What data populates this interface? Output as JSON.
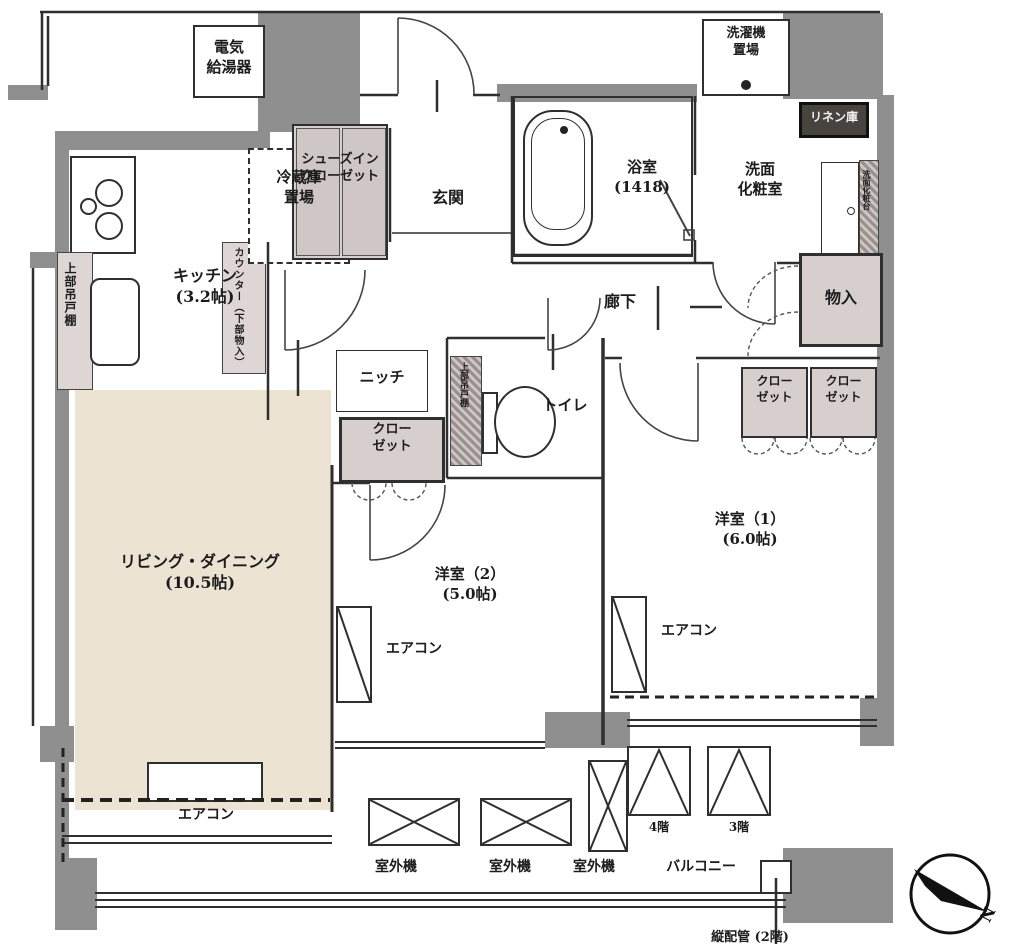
{
  "title": "間取り図",
  "colors": {
    "wall": "#8f8f8f",
    "closet_fill": "#d7cfce",
    "living_fill": "#ece3d2",
    "line": "#2f2f2f"
  },
  "labels": {
    "water_heater": "電気\n給湯器",
    "kitchen": "キッチン\n(3.2帖)",
    "fridge": "冷蔵庫\n置場",
    "shoes_closet": "シューズイン\nクローゼット",
    "counter": "カウンター（下部物入）",
    "upper_cabinet": "上部吊戸棚",
    "genkan": "玄関",
    "bath": "浴室\n(1418)",
    "washer": "洗濯機\n置場",
    "linen": "リネン庫",
    "washroom": "洗面\n化粧室",
    "vanity": "洗面化粧台",
    "monoire": "物入",
    "hallway": "廊下",
    "toilet": "トイレ",
    "niche": "ニッチ",
    "closet": "クロー\nゼット",
    "living": "リビング・ダイニング\n(10.5帖)",
    "bedroom2": "洋室（2）\n(5.0帖)",
    "bedroom1": "洋室（1）\n(6.0帖)",
    "aircon": "エアコン",
    "outdoor_unit": "室外機",
    "balcony": "バルコニー",
    "hatch_4f": "4階",
    "hatch_3f": "3階",
    "pipe_note": "縦配管 (2階)",
    "compass_n": "N"
  }
}
